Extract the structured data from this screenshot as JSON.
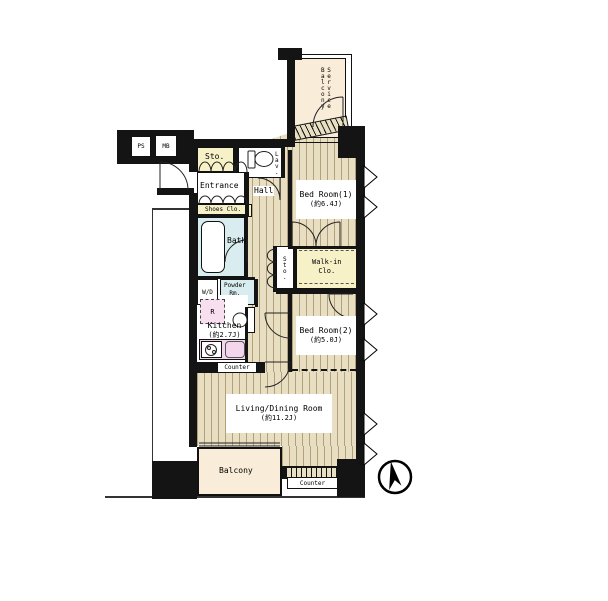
{
  "plan": {
    "type": "apartment-floor-plan",
    "rooms": {
      "service_balcony": {
        "label": "Service\nBalcony"
      },
      "bed_room_1": {
        "name": "Bed Room(1)",
        "size": "(約6.4J)"
      },
      "bed_room_2": {
        "name": "Bed Room(2)",
        "size": "(約5.0J)"
      },
      "living_dining": {
        "name": "Living/Dining Room",
        "size": "(約11.2J)"
      },
      "kitchen": {
        "name": "Kitchen",
        "size": "(約2.7J)"
      },
      "bath": {
        "name": "Bath"
      },
      "powder_room": {
        "name": "Powder\nRm."
      },
      "lavatory": {
        "name": "Lav."
      },
      "entrance": {
        "name": "Entrance"
      },
      "shoes_closet": {
        "name": "Shoes Clo."
      },
      "storage_entrance": {
        "name": "Sto."
      },
      "storage_hall": {
        "name": "Sto."
      },
      "walk_in_closet": {
        "name": "Walk-in\nClo."
      },
      "hall": {
        "name": "Hall"
      },
      "balcony": {
        "name": "Balcony"
      }
    },
    "fixtures": {
      "washer_dryer": "W/D",
      "refrigerator": "R",
      "kitchen_counter": "Counter",
      "living_counter": "Counter"
    },
    "utility": {
      "pipe_space": "PS",
      "meter_box": "MB"
    },
    "icons": {
      "north_arrow": "north-arrow-icon",
      "toilet": "toilet-icon",
      "bathtub": "bathtub-icon",
      "stove": "stove-icon",
      "kitchen_sink": "kitchen-sink-icon",
      "washbasin": "washbasin-icon"
    }
  }
}
